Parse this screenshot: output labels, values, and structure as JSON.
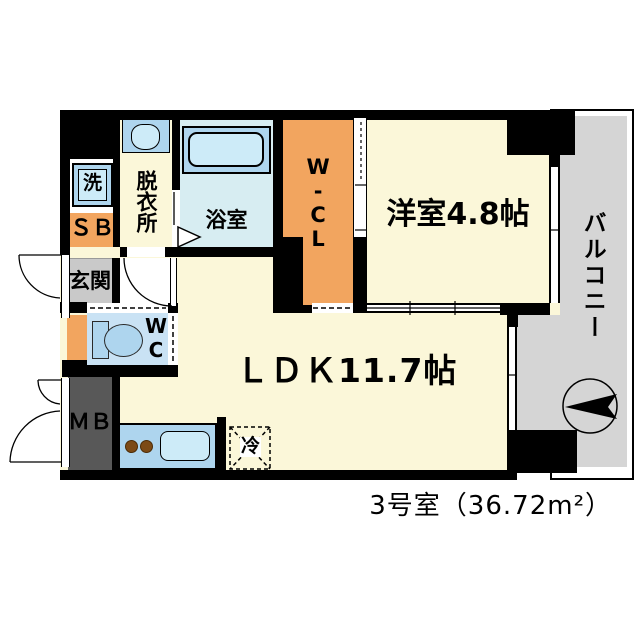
{
  "plan": {
    "rooms": {
      "laundry": {
        "label": "洗"
      },
      "shoe_box": {
        "label": "ＳＢ"
      },
      "dressing": {
        "label": "脱衣所"
      },
      "bathroom": {
        "label": "浴室"
      },
      "walkin_closet": {
        "label": "W-CL"
      },
      "western_room": {
        "label": "洋室4.8帖"
      },
      "entrance": {
        "label": "玄関"
      },
      "toilet": {
        "label": "WC"
      },
      "ldk": {
        "label": "ＬＤＫ11.7帖"
      },
      "meter_box": {
        "label": "ＭＢ"
      },
      "refrigerator": {
        "label": "冷"
      },
      "balcony": {
        "label": "バルコニー"
      }
    },
    "caption": "3号室（36.72m²）"
  },
  "icons": {
    "compass_arrow": "compass-arrow-icon",
    "door_swings": "door-swing-arc-icon",
    "bath_door": "bath-folding-door-icon"
  },
  "colors": {
    "wall": "#000000",
    "cream": "#FBF7D9",
    "bath_floor": "#D7EDF2",
    "fixture": "#AED5EE",
    "fixture_light": "#CDEBF8",
    "wc_floor": "#C9E2F4",
    "orange": "#F2A55F",
    "genkan_gray": "#C9C9C9",
    "mb_gray": "#585858",
    "balcony_gray": "#D5D5D5",
    "text": "#000000"
  }
}
